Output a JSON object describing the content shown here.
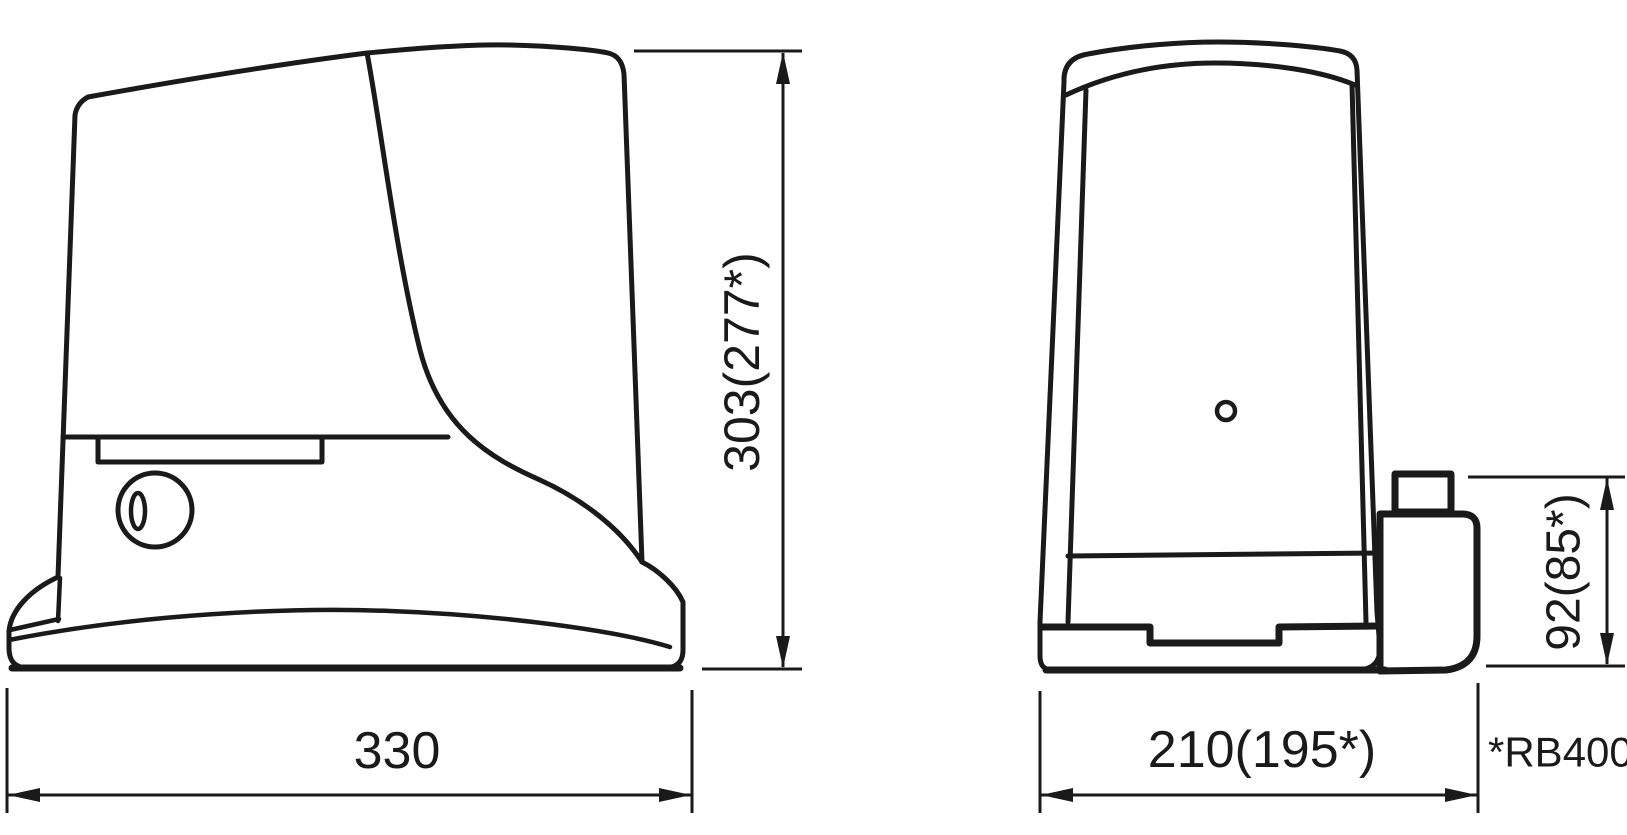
{
  "drawing": {
    "side_view": {
      "width_dim": {
        "label": "330",
        "value": 330
      },
      "height_dim": {
        "label": "303(277*)",
        "value": 303,
        "rb400_value": 277
      }
    },
    "front_view": {
      "depth_dim": {
        "label": "210(195*)",
        "value": 210,
        "rb400_value": 195
      },
      "rear_block_height_dim": {
        "label": "92(85*)",
        "value": 92,
        "rb400_value": 85
      }
    },
    "footnote": {
      "label": "*RB400"
    },
    "colors": {
      "line": "#1a1a1a",
      "background": "#ffffff"
    }
  }
}
